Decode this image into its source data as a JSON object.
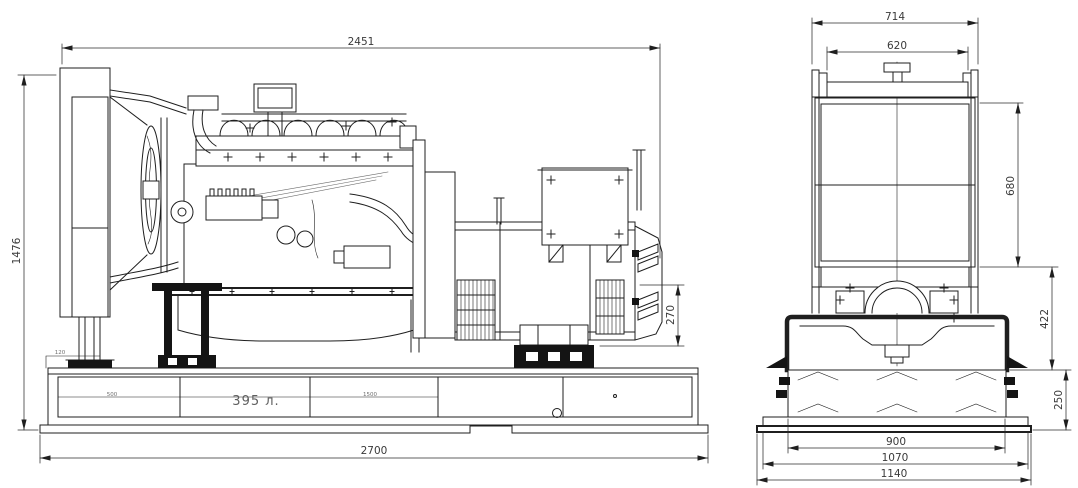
{
  "colors": {
    "line": "#1f1f1f",
    "dim_text": "#3a3a3a",
    "faint_text": "#6f6f6f",
    "background": "#ffffff"
  },
  "side_view": {
    "tank_capacity_label": "395 л.",
    "dims": {
      "overall_length": "2451",
      "overall_height": "1476",
      "generator_mount_height": "270",
      "base_length": "2700",
      "base_step": "120",
      "tank_section_left": "500",
      "tank_section_mid": "1500"
    }
  },
  "front_view": {
    "dims": {
      "radiator_frame_width": "714",
      "radiator_top_bar_width": "620",
      "radiator_core_height": "680",
      "engine_mount_height": "422",
      "base_tank_height": "250",
      "tank_width": "900",
      "shelf_width": "1070",
      "overall_base_width": "1140"
    }
  }
}
